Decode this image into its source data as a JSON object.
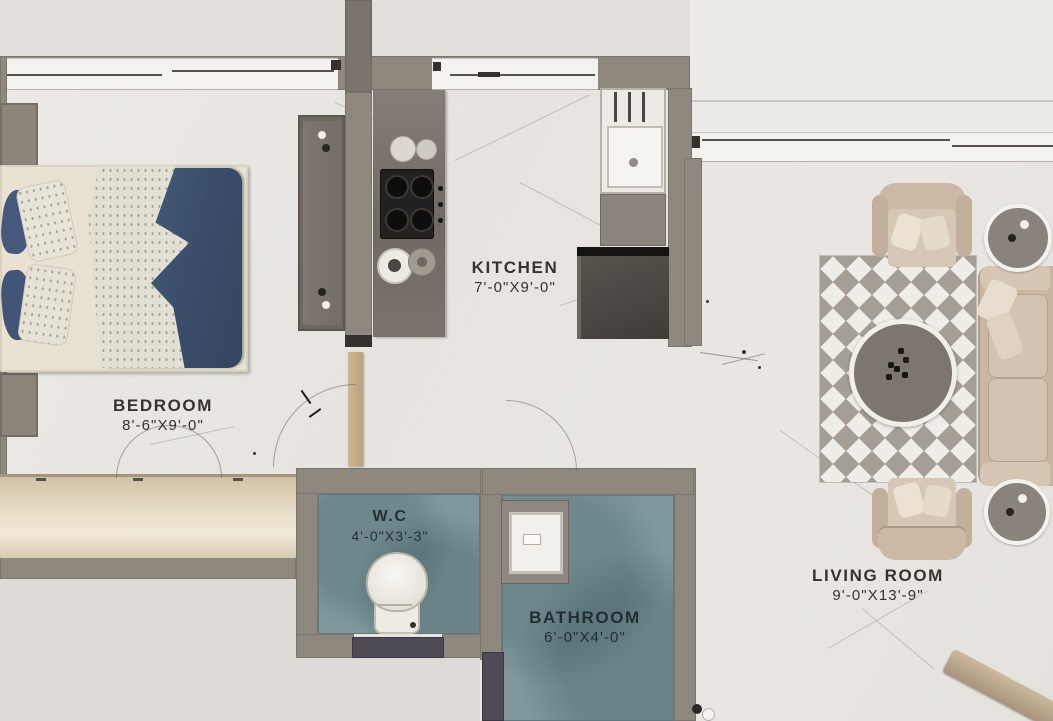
{
  "title": "apartment-floor-plan",
  "rooms": {
    "bedroom": {
      "name": "BEDROOM",
      "size": "8'-6\"X9'-0\""
    },
    "kitchen": {
      "name": "KITCHEN",
      "size": "7'-0\"X9'-0\""
    },
    "wc": {
      "name": "W.C",
      "size": "4'-0\"X3'-3\""
    },
    "bathroom": {
      "name": "BATHROOM",
      "size": "6'-0\"X4'-0\""
    },
    "living_room": {
      "name": "LIVING ROOM",
      "size": "9'-0\"X13'-9\""
    }
  },
  "colors": {
    "wall": "#8f887e",
    "floor_marble": "#e9e6e2",
    "exterior": "#e0ddd9",
    "wet_room_floor": "#7f989c",
    "bed_duvet": "#3f5470",
    "sofa_fabric": "#c9b7a3",
    "kitchen_counter": "#7c756d",
    "dark_door": "#4f4b56",
    "wood_door": "#c9b393",
    "label_text": "#262420"
  },
  "furniture": {
    "bedroom": [
      "double-bed",
      "nightstand",
      "wardrobe",
      "dresser"
    ],
    "kitchen": [
      "counter",
      "gas-stove",
      "sink",
      "refrigerator"
    ],
    "wc": [
      "toilet"
    ],
    "bathroom": [
      "wash-basin"
    ],
    "living_room": [
      "sofa",
      "armchair",
      "coffee-table",
      "side-table",
      "rug"
    ]
  }
}
